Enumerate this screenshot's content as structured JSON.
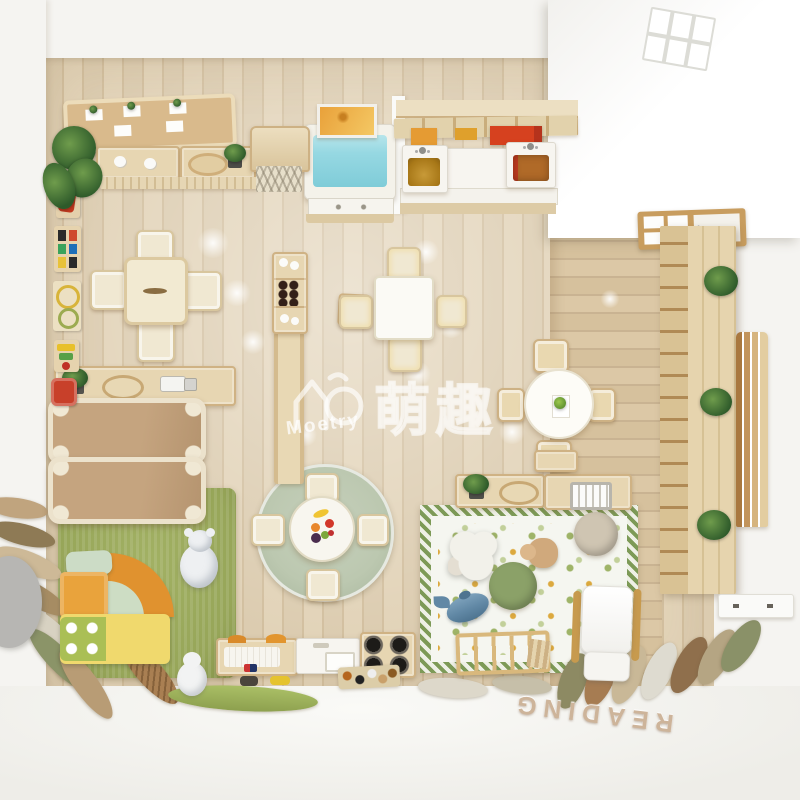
{
  "watermark": {
    "brand": "Moetry",
    "cjk": "萌趣",
    "logo": "house-m-circle-logo"
  },
  "floor_text": {
    "word": "READING"
  },
  "palette": {
    "floor_wood": "#dcccb0",
    "floor_wood_dark": "#d2bf9f",
    "corridor_wood": "#d6c19d",
    "wall": "#f5f4f1",
    "furniture_wood": "#e7d6b2",
    "furniture_wood_dark": "#cfb284",
    "cream": "#f0e8d2",
    "blue_table": "#96d8e2",
    "orange": "#e59b33",
    "yellow": "#eec23f",
    "red": "#d6411f",
    "green_rug": "#97a659",
    "sage_rug": "#bcc8b0",
    "rug_border_green": "#7d9a57",
    "cot": "#c5a47f",
    "whale": "#6188a5",
    "pouf_green": "#8ba168",
    "pouf_beige": "#cfc5b2",
    "slat": "#b5854f",
    "letters": "#cdb49a",
    "bear_white": "#eef0f2"
  }
}
